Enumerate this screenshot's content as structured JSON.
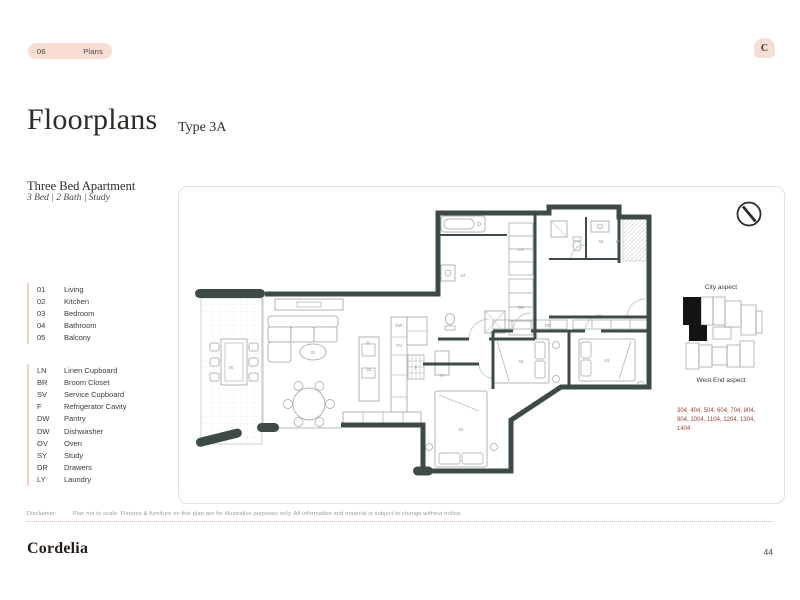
{
  "header": {
    "section_number": "06",
    "section_label": "Plans",
    "corner_mark": "C"
  },
  "title": {
    "main": "Floorplans",
    "type": "Type 3A"
  },
  "apartment": {
    "name": "Three Bed Apartment",
    "spec": "3 Bed | 2 Bath | Study"
  },
  "legend_rooms": [
    {
      "code": "01",
      "label": "Living"
    },
    {
      "code": "02",
      "label": "Kitchen"
    },
    {
      "code": "03",
      "label": "Bedroom"
    },
    {
      "code": "04",
      "label": "Bathroom"
    },
    {
      "code": "05",
      "label": "Balcony"
    }
  ],
  "legend_items": [
    {
      "code": "LN",
      "label": "Linen Cupboard"
    },
    {
      "code": "BR",
      "label": "Broom Closet"
    },
    {
      "code": "SV",
      "label": "Service Cupboard"
    },
    {
      "code": "F",
      "label": "Refrigerator Cavity"
    },
    {
      "code": "DW",
      "label": "Pantry"
    },
    {
      "code": "DW",
      "label": "Dishwasher"
    },
    {
      "code": "OV",
      "label": "Oven"
    },
    {
      "code": "SY",
      "label": "Study"
    },
    {
      "code": "DR",
      "label": "Drawers"
    },
    {
      "code": "LY",
      "label": "Laundry"
    }
  ],
  "aspect_key": {
    "top_label": "City aspect",
    "bottom_label": "West End aspect",
    "units_lines": [
      "304, 404, 504, 604, 704, 804,",
      "904, 1004, 1104, 1204, 1304,",
      "1404"
    ]
  },
  "plan": {
    "room_labels": [
      {
        "t": "05",
        "x": 40,
        "y": 170
      },
      {
        "t": "01",
        "x": 122,
        "y": 155
      },
      {
        "t": "02",
        "x": 178,
        "y": 172
      },
      {
        "t": "03",
        "x": 330,
        "y": 164
      },
      {
        "t": "03",
        "x": 416,
        "y": 163
      },
      {
        "t": "03",
        "x": 270,
        "y": 232
      },
      {
        "t": "04",
        "x": 272,
        "y": 78
      },
      {
        "t": "04",
        "x": 410,
        "y": 44
      },
      {
        "t": "SY",
        "x": 251,
        "y": 178
      },
      {
        "t": "LN",
        "x": 330,
        "y": 52
      },
      {
        "t": "BR",
        "x": 330,
        "y": 110
      },
      {
        "t": "LY",
        "x": 427,
        "y": 44
      },
      {
        "t": "F",
        "x": 225,
        "y": 170
      },
      {
        "t": "OV",
        "x": 208,
        "y": 148
      },
      {
        "t": "DW",
        "x": 208,
        "y": 128
      },
      {
        "t": "DR",
        "x": 357,
        "y": 128
      }
    ]
  },
  "footer": {
    "disclaimer_label": "Disclaimer:",
    "disclaimer_text": "Plan not to scale. Fixtures & furniture on this plan are for illustrative purposes only. All information and material is subject to change without notice.",
    "brand": "Cordelia",
    "page_number": "44"
  },
  "colors": {
    "accent_pink": "#f8ddd2",
    "wall": "#3d4b48",
    "terracotta": "#9c4631",
    "ink": "#2f2b27"
  }
}
